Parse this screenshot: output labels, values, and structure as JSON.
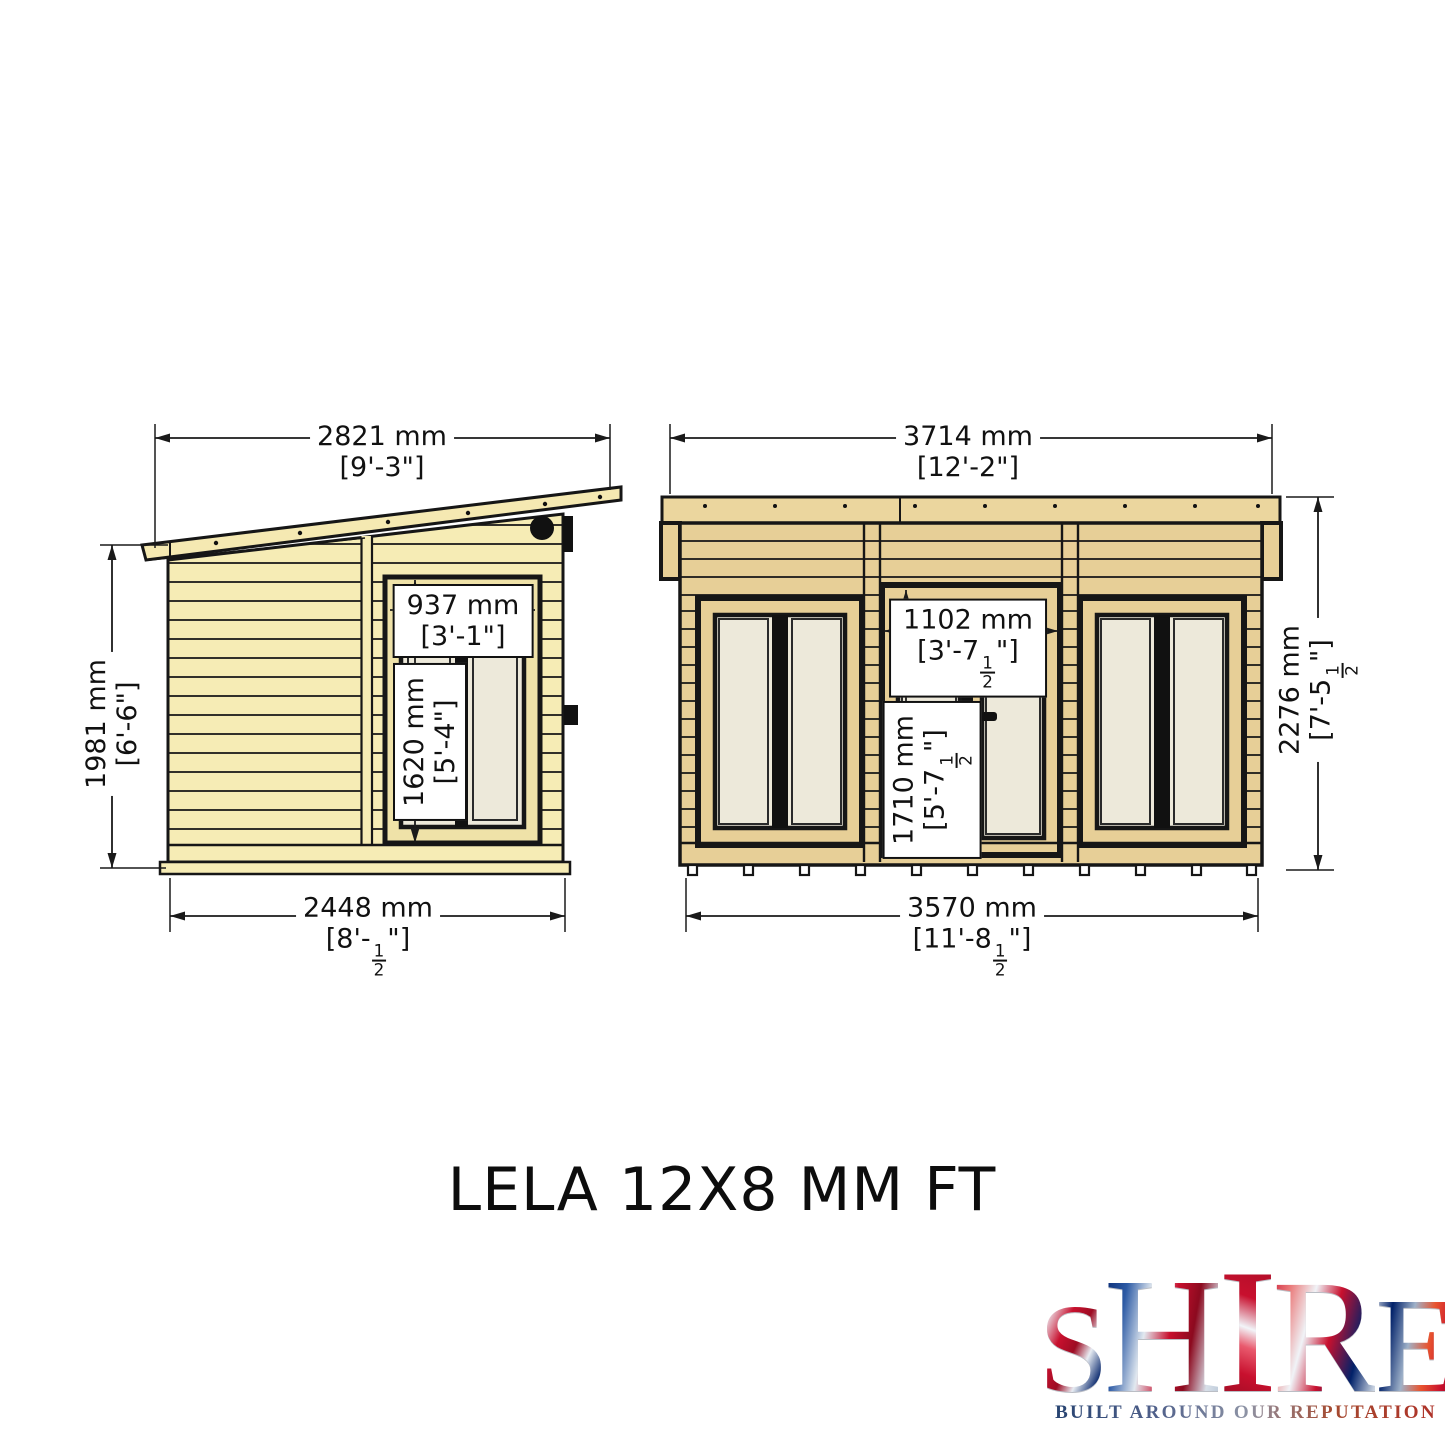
{
  "page": {
    "title": "LELA 12X8 MM FT",
    "background": "#ffffff"
  },
  "views": {
    "side": {
      "label": "side elevation",
      "dims": {
        "roof_width": {
          "mm": "2821 mm",
          "ft": "[9'-3\"]"
        },
        "wall_height": {
          "mm": "1981 mm",
          "ft": "[6'-6\"]"
        },
        "base_width": {
          "mm": "2448 mm",
          "ft": "[8'-{1/2}\"]"
        },
        "window_width": {
          "mm": "937 mm",
          "ft": "[3'-1\"]"
        },
        "window_height": {
          "mm": "1620 mm",
          "ft": "[5'-4\"]"
        }
      }
    },
    "front": {
      "label": "front elevation",
      "dims": {
        "roof_width": {
          "mm": "3714 mm",
          "ft": "[12'-2\"]"
        },
        "overall_height": {
          "mm": "2276 mm",
          "ft": "[7'-5{1/2}\"]"
        },
        "base_width": {
          "mm": "3570 mm",
          "ft": "[11'-8{1/2}\"]"
        },
        "door_width": {
          "mm": "1102 mm",
          "ft": "[3'-7{1/2}\"]"
        },
        "door_height": {
          "mm": "1710 mm",
          "ft": "[5'-7{1/2}\"]"
        }
      }
    }
  },
  "logo": {
    "letters": [
      "S",
      "H",
      "I",
      "R",
      "E"
    ],
    "tagline": "BUILT AROUND OUR REPUTATION"
  },
  "colors": {
    "side_wall": "#f6ecb5",
    "front_wall": "#e7cf97",
    "glazing": "#ede9da",
    "outline": "#161616",
    "dimension": "#1a1a1a"
  }
}
